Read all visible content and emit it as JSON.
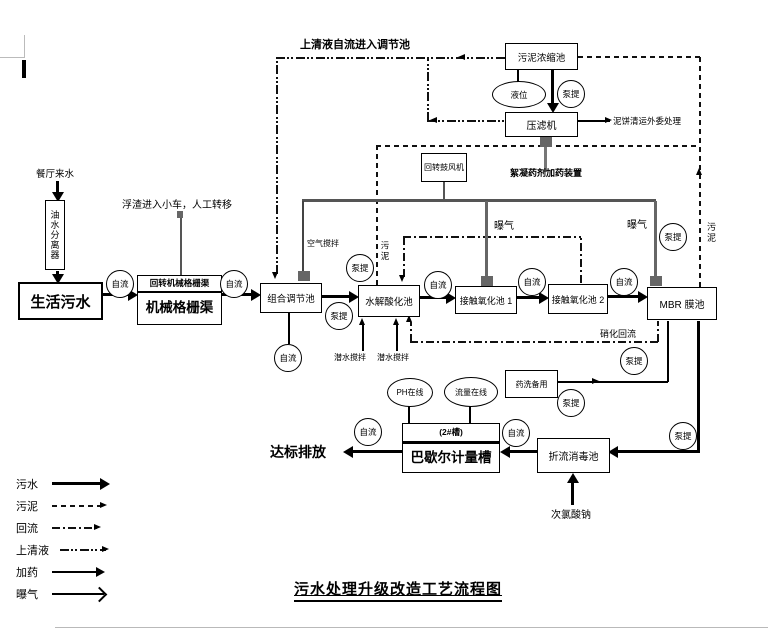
{
  "title": "污水处理升级改造工艺流程图",
  "labels": {
    "gravity": "自流",
    "pump": "泵提"
  },
  "boxes": {
    "oil_separator": "油水分离器",
    "domestic_sewage": "生活污水",
    "grille_header": "回转机械格栅渠",
    "grille": "机械格栅渠",
    "regulating_tank": "组合调节池",
    "hydrolysis_tank": "水解酸化池",
    "contact_tank_1": "接触氧化池 1",
    "contact_tank_2": "接触氧化池 2",
    "mbr_tank": "MBR 膜池",
    "sludge_thickener": "污泥浓缩池",
    "filter_press": "压滤机",
    "blower": "回转鼓风机",
    "chem_wash": "药洗备用",
    "parshall_header": "(2#槽)",
    "parshall_flume": "巴歇尔计量槽",
    "baffled_tank": "折流消毒池"
  },
  "gauges": {
    "level": "液位",
    "ph": "PH在线",
    "flow": "流量在线"
  },
  "annotations": {
    "canteen_inflow": "餐厅来水",
    "supernatant_note": "上清液自流进入调节池",
    "scum_note": "浮渣进入小车，人工转移",
    "air_mixing": "空气搅拌",
    "sludge_label_1": "污泥",
    "sludge_label_2": "污泥",
    "aeration_1": "曝气",
    "aeration_2": "曝气",
    "mud_cake_note": "泥饼清运外委处理",
    "flocculant_note": "絮凝药剂加药装置",
    "submersible_mixer_1": "潜水搅拌",
    "submersible_mixer_2": "潜水搅拌",
    "nitrification_return": "硝化回流",
    "sodium_hypochlorite": "次氯酸钠",
    "discharge": "达标排放"
  },
  "legend": {
    "items": [
      {
        "label": "污水",
        "line": "solid-thick"
      },
      {
        "label": "污泥",
        "line": "dashed"
      },
      {
        "label": "回流",
        "line": "dash-dot"
      },
      {
        "label": "上清液",
        "line": "dash-dot-dot"
      },
      {
        "label": "加药",
        "line": "solid-thin"
      },
      {
        "label": "曝气",
        "line": "solid-open-head"
      }
    ]
  }
}
